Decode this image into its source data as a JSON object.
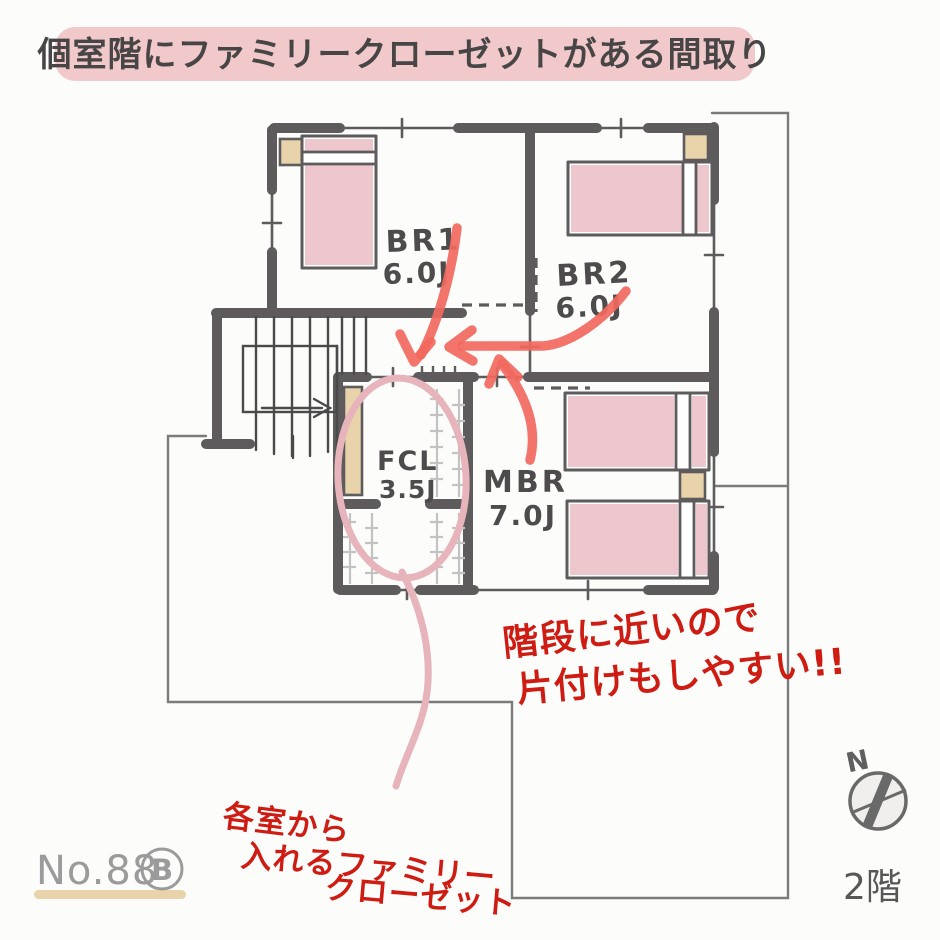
{
  "title": "個室階にファミリークローゼットがある間取り",
  "plan": {
    "floor_label": "2階",
    "plan_number": "No.88",
    "plan_number_badge": "B",
    "compass_north": "N"
  },
  "rooms": {
    "br1": {
      "name": "BR1",
      "size": "6.0J"
    },
    "br2": {
      "name": "BR2",
      "size": "6.0J"
    },
    "fcl": {
      "name": "FCL",
      "size": "3.5J"
    },
    "mbr": {
      "name": "MBR",
      "size": "7.0J"
    }
  },
  "notes": {
    "stairs_line1": "階段に近いので",
    "stairs_line2": "片付けもしやすい!!",
    "fcl_line1": "各室から",
    "fcl_line2": "入れるファミリー",
    "fcl_line3": "クローゼット"
  },
  "colors": {
    "bg": "#fcfcfb",
    "wall": "#5d5b5c",
    "banner-bg": "#f2c9ca",
    "banner-text": "#474546",
    "label-text": "#4d4b4c",
    "bed-pink": "#edc6ce",
    "tan": "#e9d3ab",
    "arrow-red": "#f1685e",
    "note-red": "#ce1c13",
    "highlight-pink": "#e7b4bb",
    "outline-gray": "#7b7b7b",
    "number-gray": "#9b9b9b"
  }
}
